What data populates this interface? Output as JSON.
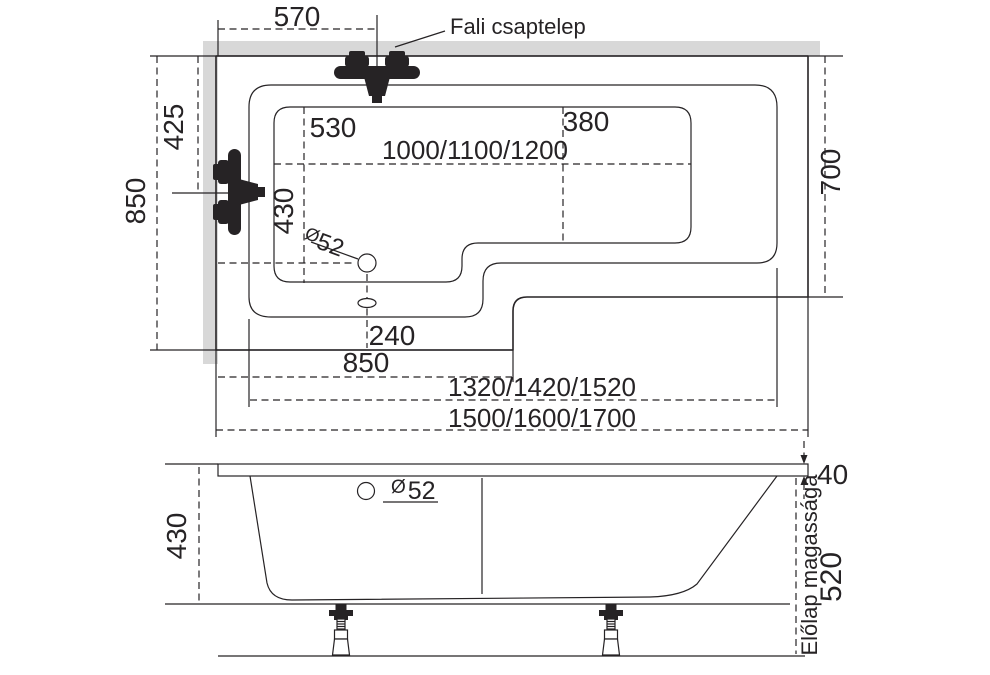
{
  "top_view": {
    "faucet_label": "Fali csaptelep",
    "dim_faucet_offset": "570",
    "dim_half_width": "425",
    "dim_width_overall": "850",
    "dim_seat_length": "530",
    "dim_head_length": "380",
    "dim_inner_length_variants": "1000/1100/1200",
    "dim_basin_width": "430",
    "drain_symbol": "Ø",
    "drain_value": "52",
    "dim_drain_offset": "240",
    "dim_foot_section_length": "850",
    "dim_rim_length_variants": "1320/1420/1520",
    "dim_overall_length_variants": "1500/1600/1700",
    "dim_right_width": "700"
  },
  "side_view": {
    "dim_depth": "430",
    "drain_symbol": "Ø",
    "drain_value": "52",
    "dim_rim_thickness": "40",
    "front_panel_label": "Előlap magassága",
    "dim_front_panel_height": "520"
  },
  "colors": {
    "line": "#262325",
    "wall": "#d8d8d8",
    "background": "#ffffff"
  }
}
